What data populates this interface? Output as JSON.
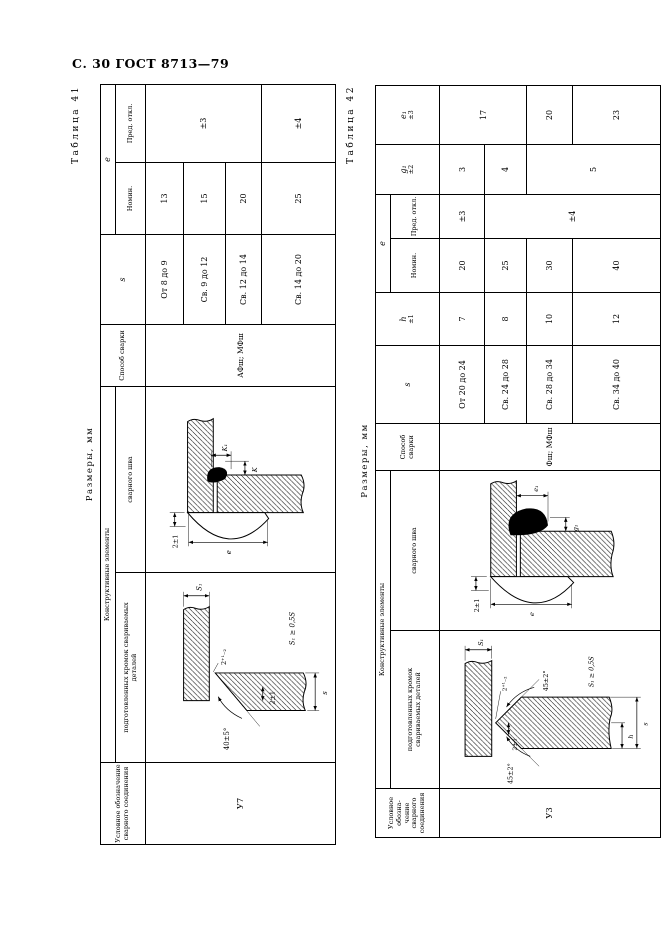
{
  "page": {
    "header": "С. 30 ГОСТ 8713—79"
  },
  "t41": {
    "label": "Таблица 41",
    "sizes": "Размеры, мм",
    "h_designation": "Условное обозначение сварного соединения",
    "h_constructive": "Конструктивные элементы",
    "h_edges": "подготовленных кромок свариваемых деталей",
    "h_weld": "сварного шва",
    "h_method": "Способ сварки",
    "h_s": "s",
    "h_e": "e",
    "h_nom": "Номин.",
    "h_dev": "Пред. откл.",
    "designation": "У7",
    "method": "АФш; МФш",
    "rows": [
      {
        "s": "От 8 до 9",
        "e": "13"
      },
      {
        "s": "Св. 9 до 12",
        "e": "15"
      },
      {
        "s": "Св. 12 до 14",
        "e": "20"
      },
      {
        "s": "Св. 14 до 20",
        "e": "25"
      }
    ],
    "dev": {
      "r123": "±3",
      "r4": "±4"
    },
    "edge": {
      "angle": "40±5°",
      "gap": "2⁺¹₋₂",
      "root": "2±1",
      "s": "s",
      "s1": "S₁",
      "note": "S₁ ≥ 0,5S"
    },
    "weld": {
      "gap": "2±1",
      "e": "e",
      "k": "K",
      "k1": "K₁"
    }
  },
  "t42": {
    "label": "Таблица 42",
    "sizes": "Размеры, мм",
    "h_designation": "Условное обозна- чение сварного соединения",
    "h_constructive": "Конструктивные элементы",
    "h_edges": "подготовленных кромок свариваемых деталей",
    "h_weld": "сварного шва",
    "h_method": "Способ сварки",
    "h_s": "s",
    "h_h": "h",
    "h_h_tol": "±1",
    "h_e": "e",
    "h_nom": "Номин.",
    "h_dev": "Пред. откл.",
    "h_g1": "g₁",
    "h_g1_tol": "±2",
    "h_e1": "e₁",
    "h_e1_tol": "±3",
    "designation": "У3",
    "method": "Фш; МФш",
    "rows": [
      {
        "s": "От 20 до 24",
        "h": "7",
        "e": "20"
      },
      {
        "s": "Св. 24 до 28",
        "h": "8",
        "e": "25"
      },
      {
        "s": "Св. 28 до 34",
        "h": "10",
        "e": "30"
      },
      {
        "s": "Св. 34 до 40",
        "h": "12",
        "e": "40"
      }
    ],
    "dev": {
      "r1": "±3",
      "r234": "±4"
    },
    "g1": {
      "r1": "3",
      "r2": "4",
      "r34": "5"
    },
    "e1": {
      "r12": "17",
      "r3": "20",
      "r4": "23"
    },
    "edge": {
      "angle_left": "45±2°",
      "angle_right": "45±2°",
      "gap": "2⁺¹₋₂",
      "root": "2±1",
      "h": "h",
      "s": "s",
      "s1": "S₁",
      "note": "S₁ ≥ 0,5S"
    },
    "weld": {
      "gap": "2±1",
      "e": "e",
      "e1": "e₁",
      "g1": "g₁"
    }
  }
}
